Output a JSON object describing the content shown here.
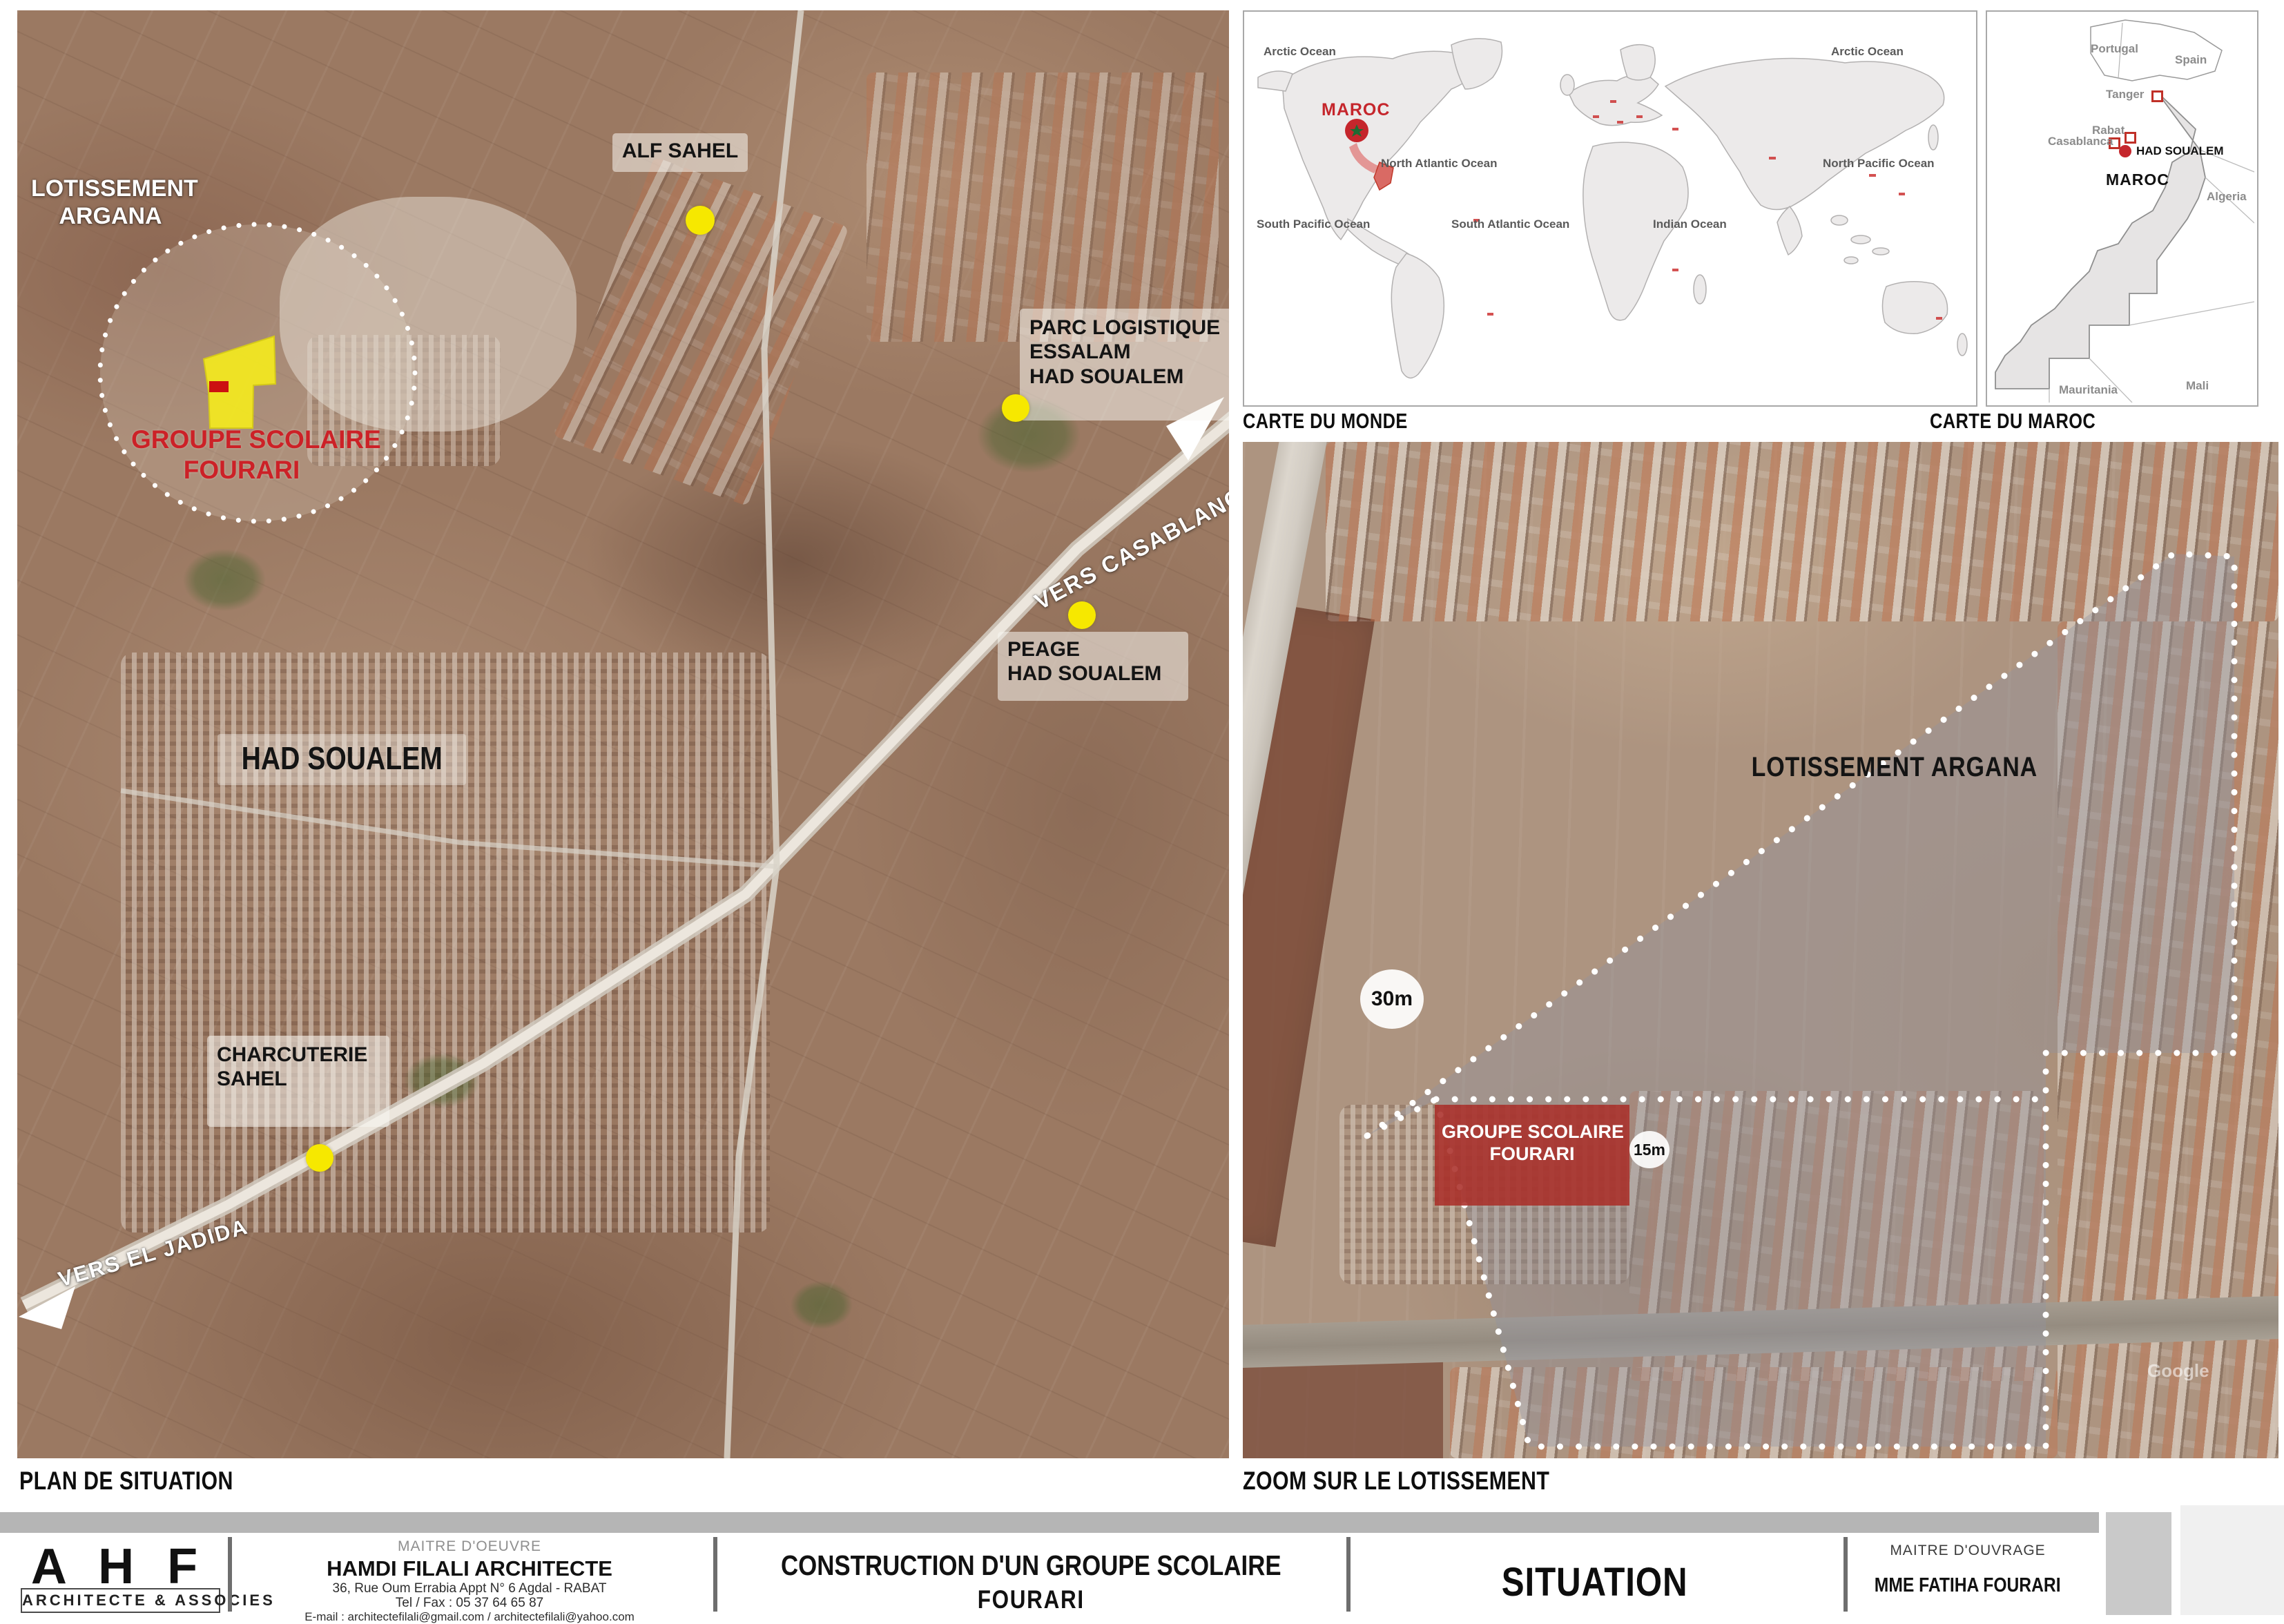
{
  "plan": {
    "caption": "PLAN DE SITUATION",
    "lotissement_l1": "LOTISSEMENT",
    "lotissement_l2": "ARGANA",
    "school_l1": "GROUPE SCOLAIRE",
    "school_l2": "FOURARI",
    "alf_sahel": "ALF SAHEL",
    "parc_l1": "PARC LOGISTIQUE",
    "parc_l2": "ESSALAM",
    "parc_l3": "HAD SOUALEM",
    "vers_casablanca": "VERS CASABLANCA",
    "peage_l1": "PEAGE",
    "peage_l2": "HAD SOUALEM",
    "city": "HAD SOUALEM",
    "charcuterie_l1": "CHARCUTERIE",
    "charcuterie_l2": "SAHEL",
    "vers_el_jadida": "VERS EL JADIDA"
  },
  "world": {
    "caption": "CARTE DU MONDE",
    "maroc": "MAROC",
    "ocean_arctic_left": "Arctic Ocean",
    "ocean_arctic_right": "Arctic Ocean",
    "ocean_north_atlantic": "North Atlantic Ocean",
    "ocean_north_pacific": "North Pacific Ocean",
    "ocean_south_pacific": "South Pacific Ocean",
    "ocean_south_atlantic": "South Atlantic Ocean",
    "ocean_indian": "Indian Ocean"
  },
  "maroc_map": {
    "caption": "CARTE DU MAROC",
    "portugal": "Portugal",
    "spain": "Spain",
    "tanger": "Tanger",
    "rabat": "Rabat",
    "casablanca": "Casablanca",
    "had_soualem": "HAD SOUALEM",
    "maroc": "MAROC",
    "algeria": "Algeria",
    "mauritania": "Mauritania",
    "mali": "Mali"
  },
  "zoom_map": {
    "caption": "ZOOM SUR LE LOTISSEMENT",
    "lotissement": "LOTISSEMENT ARGANA",
    "school_l1": "GROUPE SCOLAIRE",
    "school_l2": "FOURARI",
    "dim_30": "30m",
    "dim_15": "15m",
    "watermark": "Google"
  },
  "title_block": {
    "logo": "A H F",
    "logo_sub": "ARCHITECTE & ASSOCIES",
    "moe_title": "MAITRE D'OEUVRE",
    "moe_name": "HAMDI FILALI ARCHITECTE",
    "moe_address": "36, Rue Oum Errabia Appt N° 6 Agdal - RABAT",
    "moe_tel": "Tel / Fax : 05 37 64 65 87",
    "moe_email": "E-mail : architectefilali@gmail.com / architectefilali@yahoo.com",
    "project_l1": "CONSTRUCTION D'UN GROUPE SCOLAIRE",
    "project_l2": "FOURARI",
    "sheet_title": "SITUATION",
    "moa_title": "MAITRE D'OUVRAGE",
    "moa_name": "MME FATIHA FOURARI"
  },
  "colors": {
    "accent_red": "#cc2127",
    "marker_yellow": "#f6e800",
    "zone_yellow": "#f4ea1f",
    "school_block_red": "#a93430",
    "world_red": "#c5262c",
    "boundary_white": "#ffffff",
    "caption_black": "#0e0e0e"
  }
}
